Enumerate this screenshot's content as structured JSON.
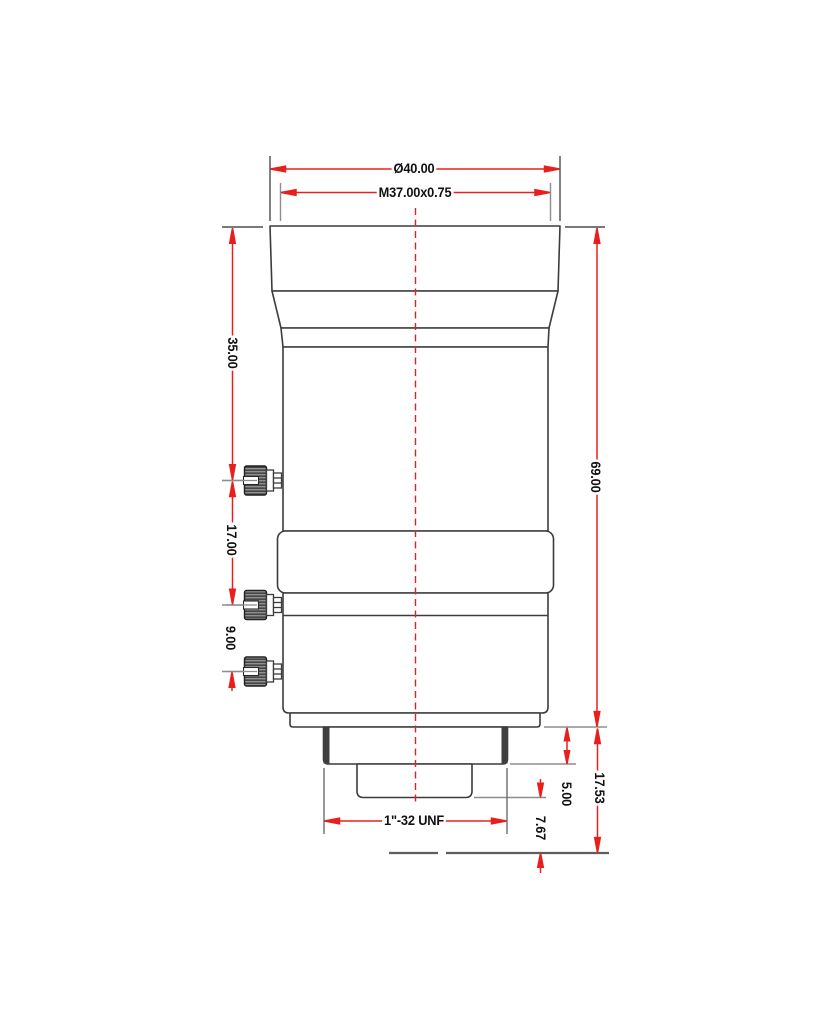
{
  "drawing": {
    "kind": "lens technical dimension drawing, side view",
    "colors": {
      "dimension_red": "#e8201d",
      "outline_dark": "#3c3c3c",
      "extension_gray": "#8d8d8d",
      "label_text": "#111111",
      "background": "#ffffff"
    },
    "dims": {
      "dia40": "Ø40.00",
      "m37": "M37.00x0.75",
      "len35": "35.00",
      "len17": "17.00",
      "len9": "9.00",
      "len69": "69.00",
      "len1753": "17.53",
      "len5": "5.00",
      "len767": "7.67",
      "unf": "1\"-32 UNF"
    }
  }
}
